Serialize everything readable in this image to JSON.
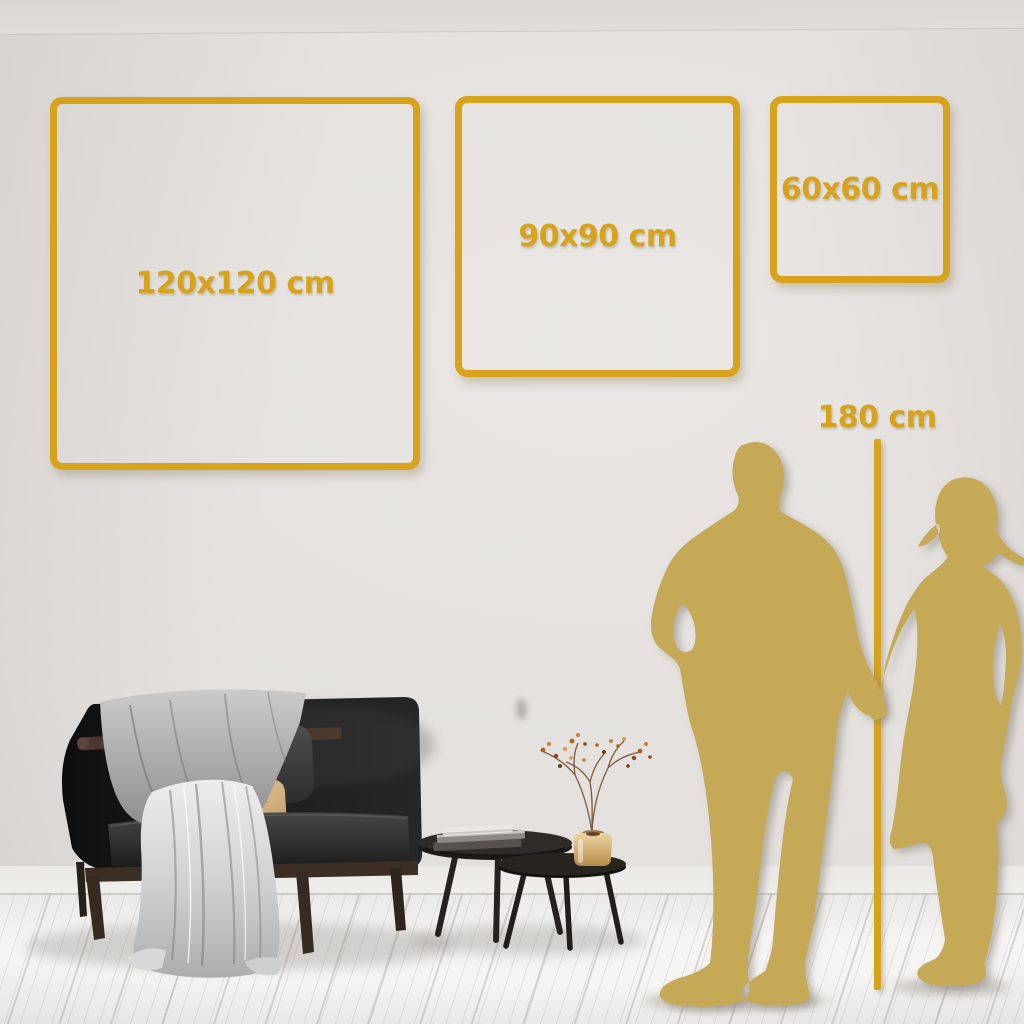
{
  "size_guide": {
    "squares": [
      {
        "label": "120x120 cm"
      },
      {
        "label": "90x90 cm"
      },
      {
        "label": "60x60 cm"
      }
    ],
    "height_marker": {
      "label": "180 cm"
    }
  },
  "colors": {
    "accent_gold": "#D7A31C",
    "silhouette_gold": "#C6A956",
    "wall": "#E3E0DD",
    "floor": "#F3F2F0"
  },
  "scene_objects": [
    "man-silhouette",
    "woman-silhouette",
    "height-line",
    "sofa",
    "throw-blanket",
    "gray-back-pillow",
    "tan-pillow",
    "nesting-coffee-tables",
    "book-stack",
    "brass-vase",
    "dried-branch-plant"
  ]
}
